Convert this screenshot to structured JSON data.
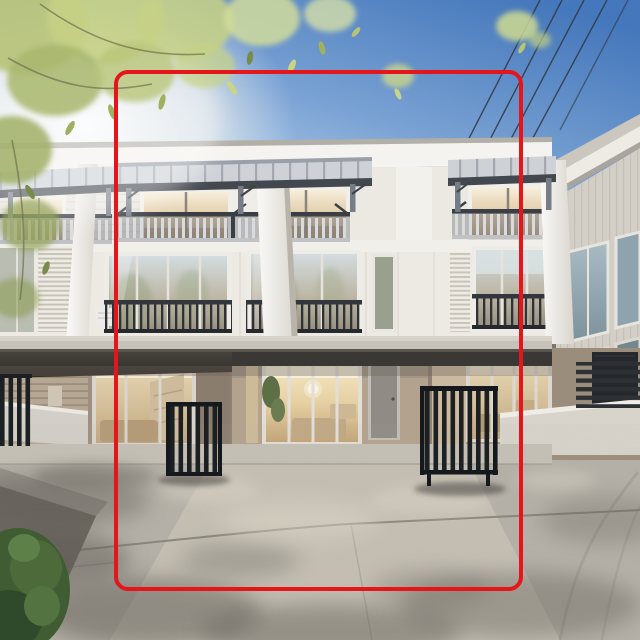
{
  "meta": {
    "content_type": "annotated photograph",
    "description": "Street-level photo of a modern three-storey townhouse row in daylight; a red rounded rectangle is drawn over the photo highlighting the centre townhouse unit from roof canopy to driveway.",
    "image_width_px": 640,
    "image_height_px": 640
  },
  "annotation": {
    "shape": "rounded-rectangle",
    "x": 114,
    "y": 70,
    "width": 409,
    "height": 521,
    "corner_radius": 14,
    "stroke_width": 4.5,
    "color": "#e5161b"
  },
  "scene": {
    "storeys": 3,
    "power_line_count": 4,
    "visible_units": "one full centre unit highlighted, partial units left and right, neighbouring building far right",
    "features": [
      "steel balcony canopies",
      "balcony railings",
      "floor-to-ceiling windows",
      "carports with warm interior lighting",
      "sliding glass doors",
      "grey entry door",
      "black slatted folding gates",
      "concrete driveway with dappled tree shadows",
      "overhanging tree foliage top-left",
      "green shrub bottom-left",
      "blue sky with power lines"
    ]
  },
  "palette": {
    "annotation_red": "#e5161b",
    "sky_top": "#4477bb",
    "sky_horizon": "#f6f3ec",
    "sun_glow": "#ffffff",
    "facade_white": "#e9e6df",
    "fascia_white": "#f4f3ef",
    "canopy_frame": "#43484f",
    "railing_dark": "#2e3136",
    "railing_light": "#d9dbdd",
    "slab_grey": "#c6c2b9",
    "carport_ceiling": "#3a3834",
    "interior_glow": "#ead8b2",
    "gate_black": "#1d2023",
    "entry_door_grey": "#908c85",
    "driveway_grey": "#b5b0a7",
    "shadow_grey": "#5f5b54",
    "leaf_green": "#c6d085",
    "shrub_green": "#3f5c32"
  }
}
